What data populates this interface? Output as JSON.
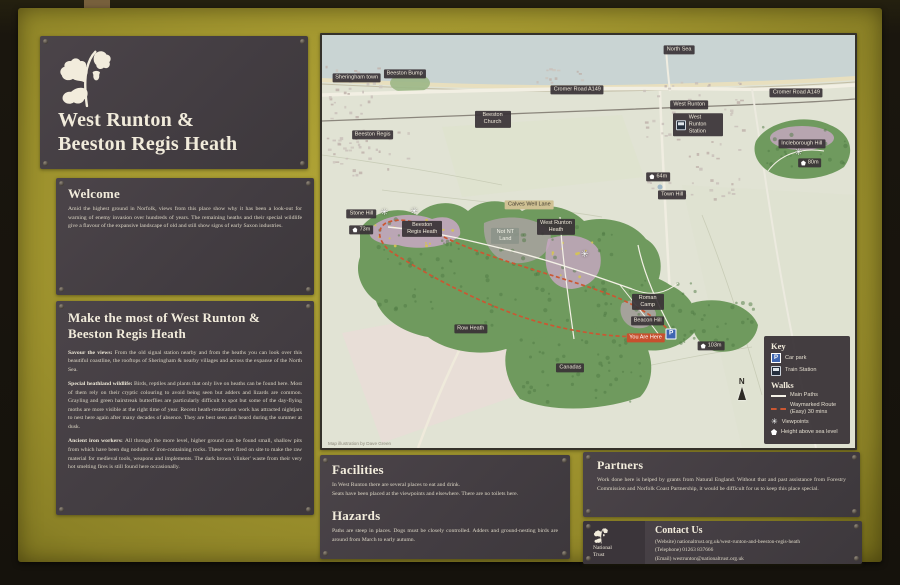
{
  "colors": {
    "board": "#a79b2e",
    "panel": "#464045",
    "accent_red": "#c8502e",
    "route": "#cb5732",
    "sea": "#c9d4d3",
    "wood": "#6f9a5e",
    "heather": "#c9a8c4"
  },
  "sign": {
    "title": {
      "line1": "West Runton &",
      "line2": "Beeston Regis Heath"
    },
    "welcome": {
      "heading": "Welcome",
      "body": "Amid the highest ground in Norfolk, views from this place show why it has been a look-out for warning of enemy invasion over hundreds of years. The remaining heaths and their special wildlife give a flavour of the expansive landscape of old and still show signs of early Saxon industries."
    },
    "make_the_most": {
      "heading": "Make the most of  West Runton & Beeston Regis Heath",
      "paragraphs": [
        {
          "lead": "Savour the views:",
          "text": "From the old signal station nearby and from the heaths you can look over this beautiful coastline, the rooftops of Sheringham & nearby villages and across the expanse of the North Sea."
        },
        {
          "lead": "Special heathland wildlife:",
          "text": "Birds, reptiles and plants that only live on heaths can be found here. Most of them rely on their cryptic colouring to avoid being seen but adders and lizards are common. Grayling and green hairstreak butterflies are particularly difficult to spot but some of the day-flying moths are more visible at the right time of year. Recent heath-restoration work has attracted nightjars to nest here again after many decades of absence. They are best seen and heard during the summer at dusk."
        },
        {
          "lead": "Ancient iron workers:",
          "text": "All through the more level, higher ground can be found small, shallow pits from which have been dug nodules of iron-containing rocks. These were fired on site to make the raw material for medieval tools, weapons and implements. The dark brown 'clinker' waste from their very hot smelting fires is still found here occasionally."
        }
      ]
    },
    "facilities": {
      "heading": "Facilities",
      "body": "In West Runton there are several places to eat and drink.\nSeats have been placed at the viewpoints and elsewhere.  There are no toilets here."
    },
    "hazards": {
      "heading": "Hazards",
      "body": "Paths are steep in places. Dogs must be closely controlled.  Adders and ground-nesting birds are around from March to early autumn."
    },
    "partners": {
      "heading": "Partners",
      "body": "Work done here is helped by grants from Natural England. Without that and past assistance from Forestry Commission and Norfolk Coast Partnership, it would be difficult for us to keep this place special."
    },
    "contact": {
      "heading": "Contact Us",
      "org": "National Trust",
      "lines": [
        "(Website) nationaltrust.org.uk/west-runton-and-beeston-regis-heath",
        "(Telephone) 01263 837666",
        "(Email) westrunton@nationaltrust.org.uk"
      ]
    }
  },
  "map": {
    "compass": "N",
    "credit": "Map illustration by Dave Green",
    "key": {
      "heading": "Key",
      "items": [
        {
          "icon": "carpark",
          "label": "Car park"
        },
        {
          "icon": "train",
          "label": "Train Station"
        }
      ],
      "walks_heading": "Walks",
      "walk_items": [
        {
          "icon": "path",
          "label": "Main Paths"
        },
        {
          "icon": "route",
          "label": "Waymarked Route (Easy) 30 mins"
        },
        {
          "icon": "view",
          "label": "Viewpoints"
        },
        {
          "icon": "height",
          "label": "Height above sea level"
        }
      ]
    },
    "labels": [
      {
        "text": "North Sea",
        "type": "dark",
        "x": 67.0,
        "y": 3.6
      },
      {
        "text": "Beeston Bump",
        "type": "dark",
        "x": 15.5,
        "y": 9.4
      },
      {
        "text": "Sheringham town",
        "type": "dark",
        "x": 6.5,
        "y": 10.3
      },
      {
        "text": "Beeston Church",
        "type": "dark",
        "x": 32.0,
        "y": 20.4,
        "w": 30
      },
      {
        "text": "Beeston Regis",
        "type": "dark",
        "x": 9.5,
        "y": 24.2
      },
      {
        "text": "Cromer Road A149",
        "type": "dark",
        "x": 47.9,
        "y": 13.2
      },
      {
        "text": "Cromer Road A149",
        "type": "dark",
        "x": 89.0,
        "y": 14.1
      },
      {
        "text": "West Runton",
        "type": "dark",
        "x": 68.9,
        "y": 17.0
      },
      {
        "text": "West Runton Station",
        "type": "station",
        "x": 70.5,
        "y": 21.8
      },
      {
        "text": "64m",
        "type": "height",
        "x": 63.1,
        "y": 34.3
      },
      {
        "text": "Town Hill",
        "type": "dark",
        "x": 65.7,
        "y": 38.8
      },
      {
        "text": "Incleborough Hill",
        "type": "dark",
        "x": 90.0,
        "y": 26.4
      },
      {
        "text": "80m",
        "type": "height",
        "x": 91.5,
        "y": 31.0
      },
      {
        "text": "Stone Hill",
        "type": "dark",
        "x": 7.4,
        "y": 43.4
      },
      {
        "text": "73m",
        "type": "height",
        "x": 7.4,
        "y": 47.2
      },
      {
        "text": "Beeston Regis Heath",
        "type": "dark",
        "x": 18.8,
        "y": 47.0,
        "w": 34
      },
      {
        "text": "Calves Well Lane",
        "type": "tan",
        "x": 38.9,
        "y": 41.2
      },
      {
        "text": "Not NT Land",
        "type": "grey",
        "x": 34.4,
        "y": 48.7,
        "w": 22
      },
      {
        "text": "West Runton Heath",
        "type": "dark",
        "x": 43.9,
        "y": 46.5,
        "w": 32
      },
      {
        "text": "Roman Camp",
        "type": "dark",
        "x": 61.1,
        "y": 64.7,
        "w": 26
      },
      {
        "text": "Beacon Hill",
        "type": "dark",
        "x": 61.1,
        "y": 69.2
      },
      {
        "text": "You Are Here",
        "type": "red",
        "x": 60.7,
        "y": 73.4
      },
      {
        "text": "P",
        "type": "carpark",
        "x": 65.5,
        "y": 72.4
      },
      {
        "text": "103m",
        "type": "height",
        "x": 73.0,
        "y": 75.3
      },
      {
        "text": "Row Heath",
        "type": "dark",
        "x": 27.9,
        "y": 71.2
      },
      {
        "text": "Canadas",
        "type": "dark",
        "x": 46.6,
        "y": 80.6
      },
      {
        "text": "",
        "type": "viewpoint",
        "x": 11.7,
        "y": 43.2
      },
      {
        "text": "",
        "type": "viewpoint",
        "x": 17.3,
        "y": 42.8
      },
      {
        "text": "",
        "type": "viewpoint",
        "x": 49.3,
        "y": 53.2
      },
      {
        "text": "",
        "type": "viewpoint",
        "x": 89.4,
        "y": 28.6
      }
    ]
  }
}
